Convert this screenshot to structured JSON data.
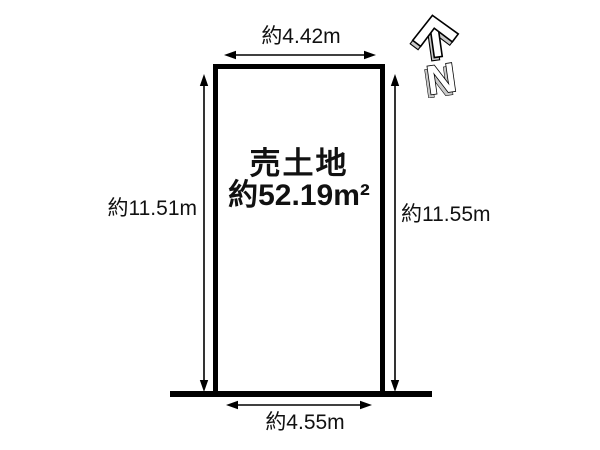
{
  "page": {
    "background": "#ffffff",
    "line_color": "#000000"
  },
  "plot": {
    "type_label": "売土地",
    "area_label": "約52.19m²"
  },
  "dimensions": {
    "top": "約4.42m",
    "bottom": "約4.55m",
    "left": "約11.51m",
    "right": "約11.55m"
  },
  "compass": {
    "letter": "N",
    "shade_color": "#c9c9c9"
  }
}
